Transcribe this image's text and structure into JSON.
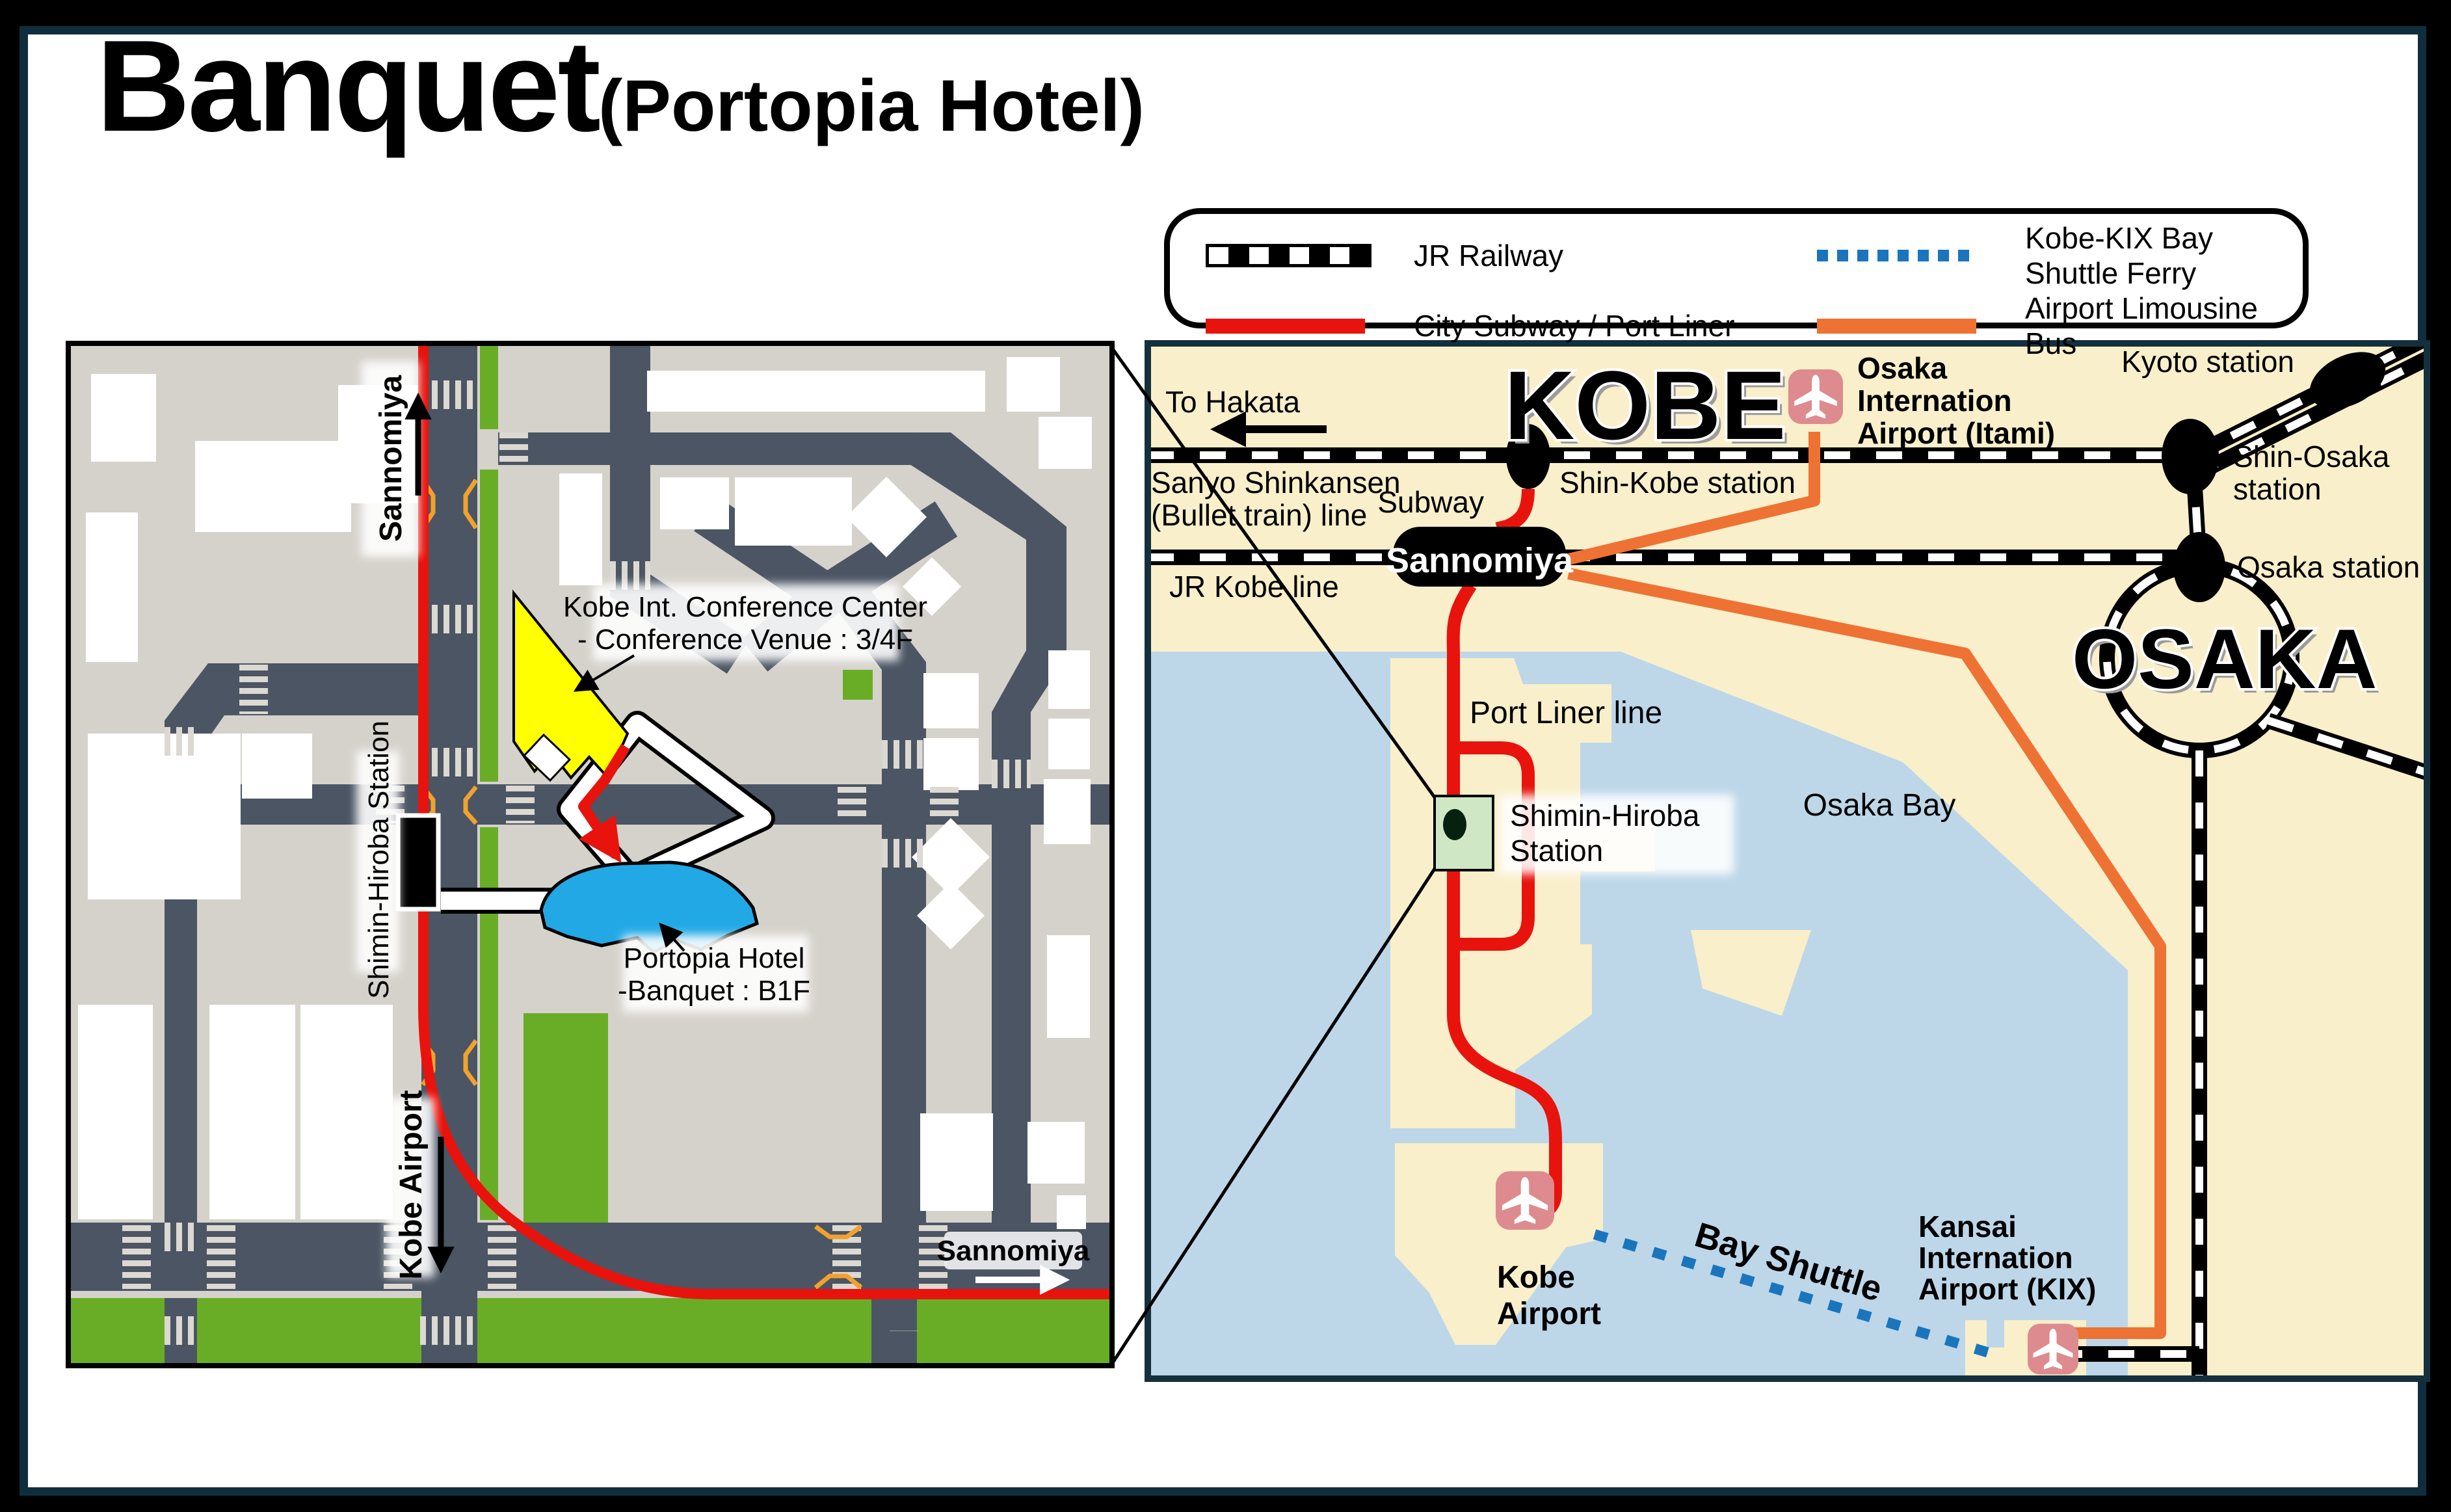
{
  "title": {
    "main": "Banquet",
    "sub": "(Portopia Hotel)"
  },
  "legend": {
    "items": [
      {
        "id": "jr",
        "label": "JR Railway"
      },
      {
        "id": "ferry",
        "label": "Kobe-KIX Bay Shuttle Ferry"
      },
      {
        "id": "subway",
        "label": "City Subway / Port Liner"
      },
      {
        "id": "bus",
        "label": "Airport Limousine Bus"
      }
    ]
  },
  "colors": {
    "subway_red": "#e8130d",
    "limousine_orange": "#ee7233",
    "ferry_blue": "#1b75bc",
    "land_cream": "#f9efca",
    "water_blue": "#bdd7e9",
    "detail_grey": "#d5d2cb",
    "road_slate": "#4b5563",
    "park_green": "#69ad27",
    "station_area_green": "#cfe7c5",
    "hotel_blue": "#23a8e6",
    "venue_yellow": "#ffff00",
    "airport_pink": "#dd8b8e",
    "frame_navy": "#0f2d3d"
  },
  "detail_map": {
    "sannomiya_top": "Sannomiya",
    "conference_label_1": "Kobe Int. Conference Center",
    "conference_label_2": "- Conference Venue : 3/4F",
    "station_label": "Shimin-Hiroba Station",
    "hotel_label_1": "Portopia Hotel",
    "hotel_label_2": "-Banquet : B1F",
    "kobe_airport": "Kobe Airport",
    "sannomiya_bottom": "Sannomiya"
  },
  "region_map": {
    "kobe_title": "KOBE",
    "osaka_title": "OSAKA",
    "to_hakata": "To Hakata",
    "sanyo_line": [
      "Sanyo Shinkansen",
      "(Bullet train) line"
    ],
    "subway": "Subway",
    "shin_kobe": "Shin-Kobe station",
    "jr_kobe": "JR Kobe line",
    "sannomiya": "Sannomiya",
    "itami": [
      "Osaka",
      "Internation",
      "Airport (Itami)"
    ],
    "kyoto": "Kyoto station",
    "shin_osaka": [
      "Shin-Osaka",
      "station"
    ],
    "osaka_station": "Osaka station",
    "port_liner": "Port Liner line",
    "shimin_hiroba": [
      "Shimin-Hiroba",
      "Station"
    ],
    "osaka_bay": "Osaka Bay",
    "kobe_airport": [
      "Kobe",
      "Airport"
    ],
    "bay_shuttle": "Bay Shuttle",
    "kix": [
      "Kansai",
      "Internation",
      "Airport (KIX)"
    ]
  }
}
